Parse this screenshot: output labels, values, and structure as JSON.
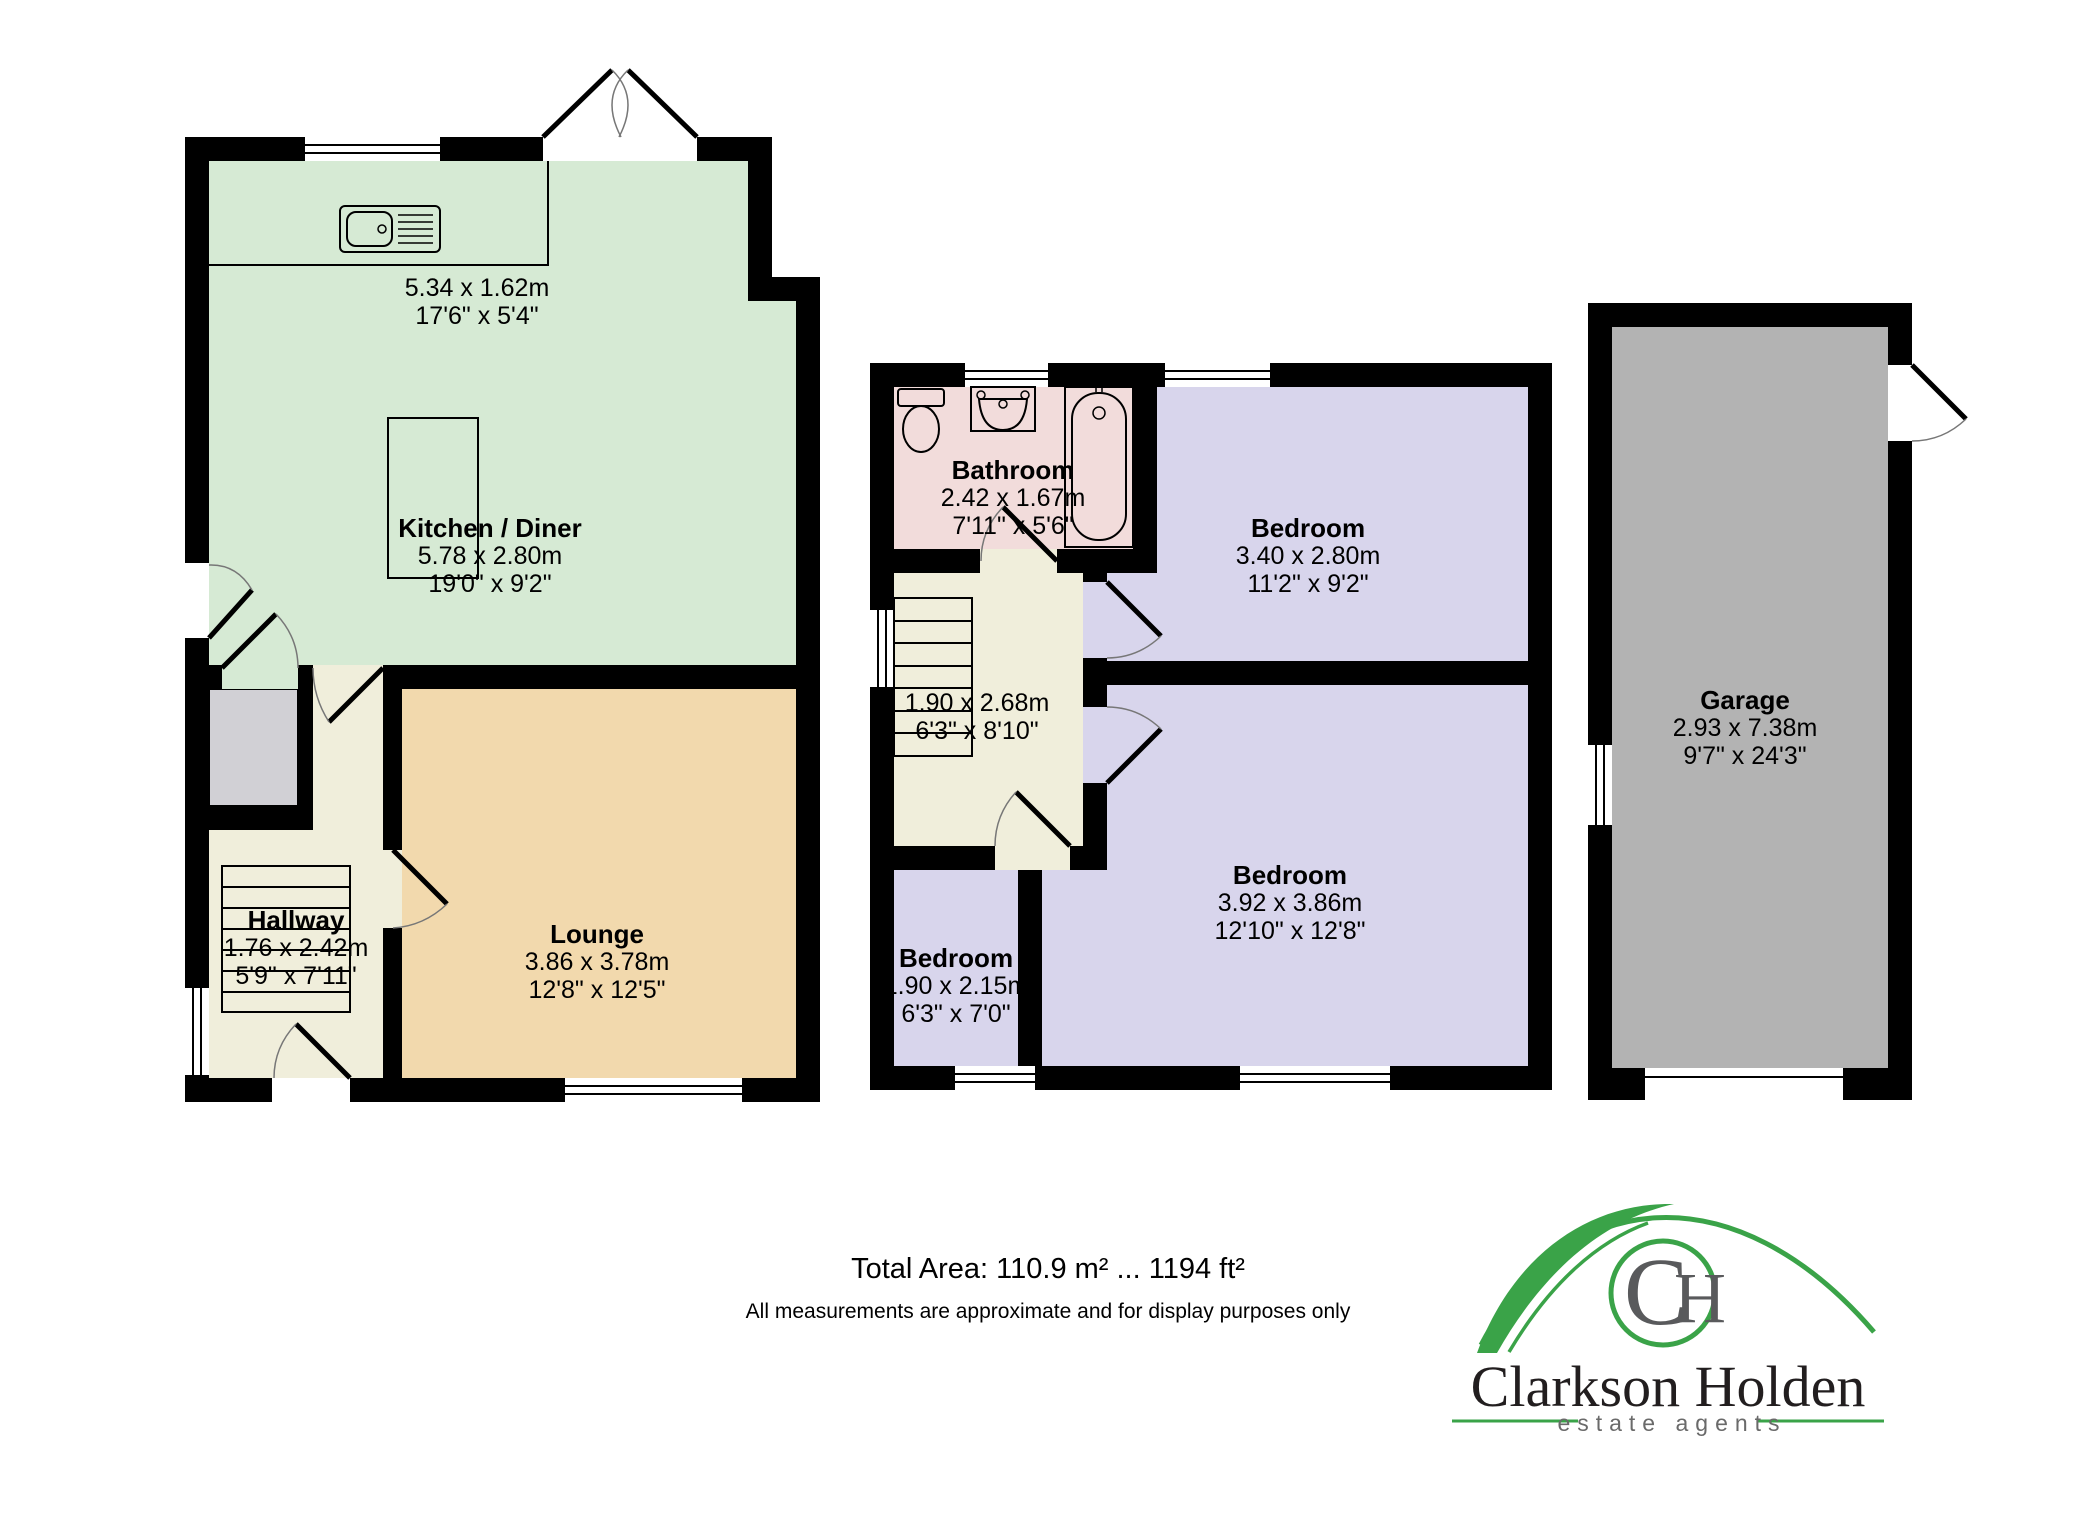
{
  "ground_floor": {
    "labels": {
      "kitchen_counter": {
        "metric": "5.34 x 1.62m",
        "imperial": "17'6\" x 5'4\""
      },
      "kitchen": {
        "name": "Kitchen / Diner",
        "metric": "5.78 x 2.80m",
        "imperial": "19'0\" x 9'2\""
      },
      "hallway": {
        "name": "Hallway",
        "metric": "1.76 x 2.42m",
        "imperial": "5'9\" x 7'11\""
      },
      "lounge": {
        "name": "Lounge",
        "metric": "3.86 x 3.78m",
        "imperial": "12'8\" x 12'5\""
      }
    }
  },
  "first_floor": {
    "labels": {
      "bathroom": {
        "name": "Bathroom",
        "metric": "2.42 x 1.67m",
        "imperial": "7'11\" x 5'6\""
      },
      "bedroom1": {
        "name": "Bedroom",
        "metric": "3.40 x 2.80m",
        "imperial": "11'2\" x 9'2\""
      },
      "landing": {
        "metric": "1.90 x 2.68m",
        "imperial": "6'3\" x 8'10\""
      },
      "bedroom2": {
        "name": "Bedroom",
        "metric": "3.92 x 3.86m",
        "imperial": "12'10\" x 12'8\""
      },
      "bedroom3": {
        "name": "Bedroom",
        "metric": "1.90 x 2.15m",
        "imperial": "6'3\" x 7'0\""
      }
    }
  },
  "garage": {
    "labels": {
      "garage": {
        "name": "Garage",
        "metric": "2.93 x 7.38m",
        "imperial": "9'7\" x 24'3\""
      }
    }
  },
  "footer": {
    "total_area": "Total Area: 110.9 m² ... 1194 ft²",
    "disclaimer": "All measurements are approximate and for display purposes only"
  },
  "logo": {
    "monogram_c": "C",
    "monogram_h": "H",
    "name": "Clarkson Holden",
    "tagline": "estate agents"
  },
  "colors": {
    "wall": "#000000",
    "kitchen": "#d6ead4",
    "lounge": "#f2d9ad",
    "hall": "#f0eedb",
    "bathroom": "#f2dcdb",
    "bedroom": "#d8d5ec",
    "garage_floor": "#b3b3b3",
    "store": "#d1d0d5",
    "logo_green": "#3aa348",
    "logo_gray": "#58595b"
  }
}
